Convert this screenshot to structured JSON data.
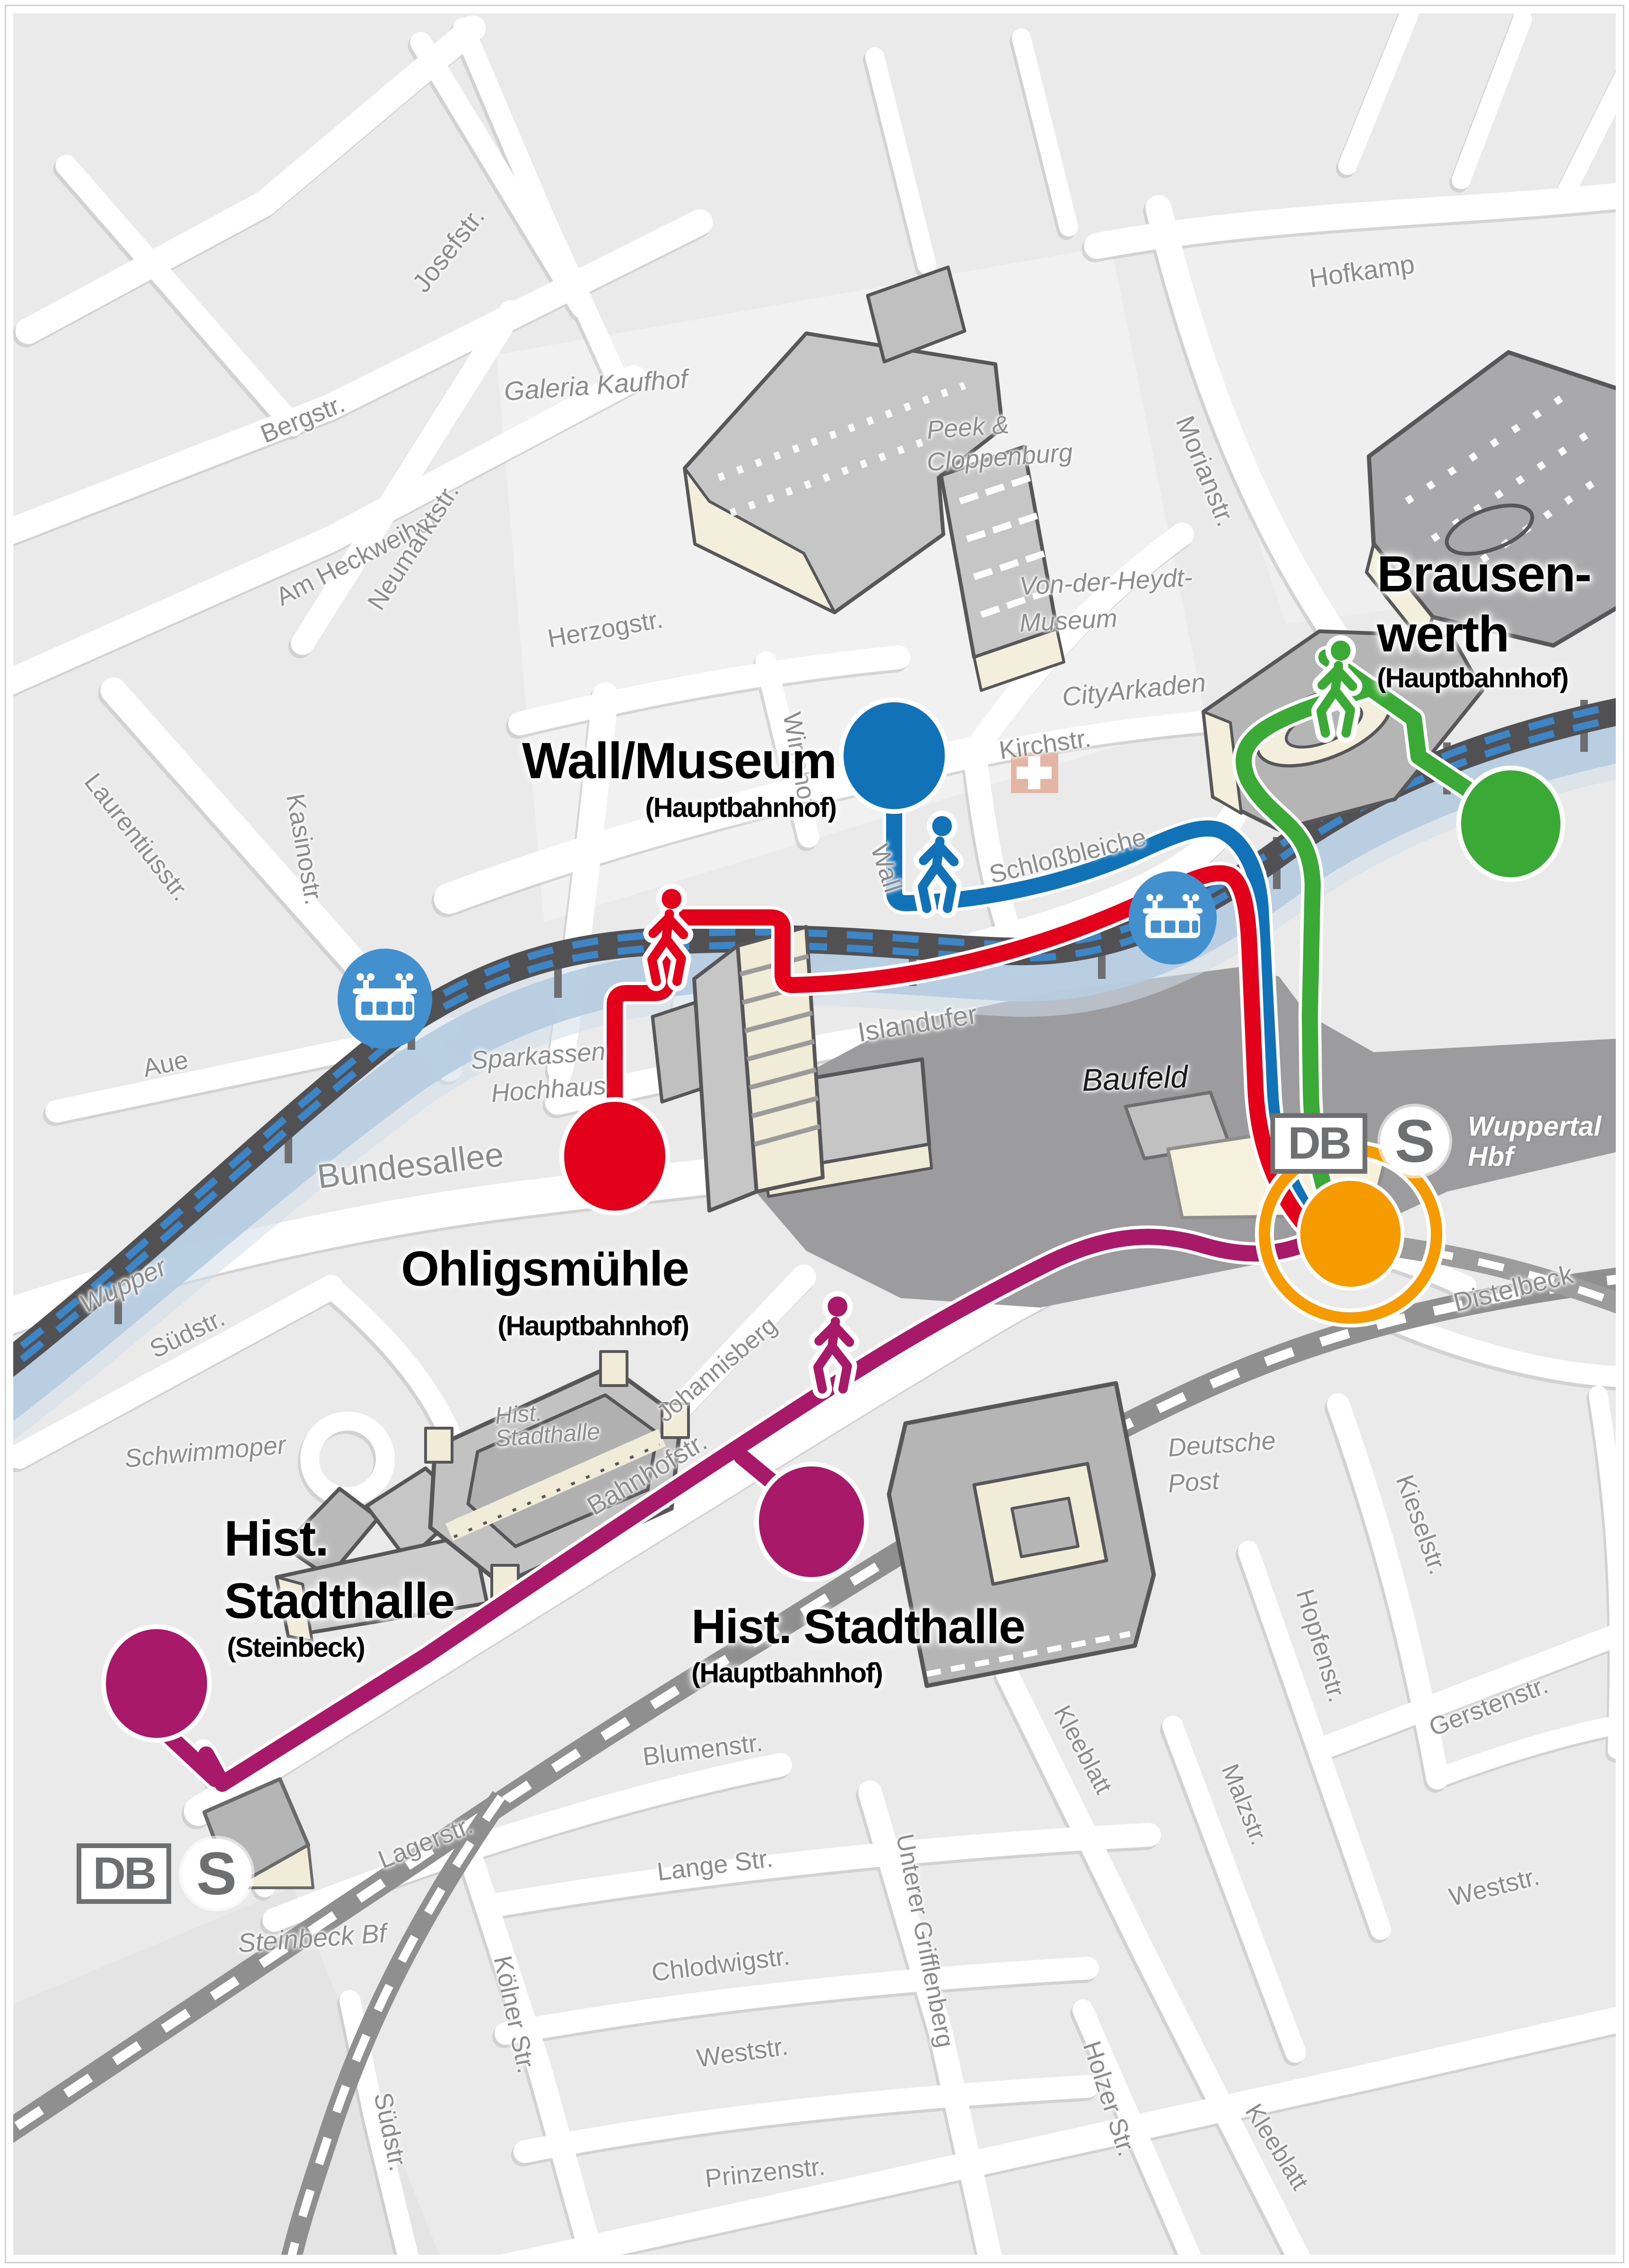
{
  "streets": {
    "josefstr": "Josefstr.",
    "bergstr": "Bergstr.",
    "am_heckweiher": "Am Heckweiher",
    "neumarktstr": "Neumarktstr.",
    "hofkamp": "Hofkamp",
    "morianstr": "Morianstr.",
    "herzogstr": "Herzogstr.",
    "wirmhof": "Wirmhof",
    "kirchstr": "Kirchstr.",
    "wall": "Wall",
    "schlossbleiche": "Schloßbleiche",
    "laurentiusstr": "Laurentiusstr.",
    "kasinostr": "Kasinostr.",
    "aue": "Aue",
    "islandufer": "Islandufer",
    "bundesallee": "Bundesallee",
    "suedstr_upper": "Südstr.",
    "johannisberg": "Johannisberg",
    "bahnhofstr": "Bahnhofstr.",
    "distelbeck": "Distelbeck",
    "kieselstr": "Kieselstr.",
    "hopfenstr": "Hopfenstr.",
    "gerstenstr": "Gerstenstr.",
    "kleeblatt_upper": "Kleeblatt",
    "kleeblatt_lower": "Kleeblatt",
    "malzstr": "Malzstr.",
    "weststr_right": "Weststr.",
    "weststr_center": "Weststr.",
    "holzer_str": "Holzer Str.",
    "blumenstr": "Blumenstr.",
    "lange_str": "Lange Str.",
    "chlodwigstr": "Chlodwigstr.",
    "koelner_str": "Kölner Str.",
    "unterer_grifflenberg": "Unterer Grifflenberg",
    "lagerstr": "Lagerstr.",
    "suedstr_lower": "Südstr.",
    "prinzenstr": "Prinzenstr."
  },
  "places": {
    "galeria_kaufhof": "Galeria Kaufhof",
    "peek_1": "Peek &",
    "peek_2": "Cloppenburg",
    "vdh_1": "Von-der-Heydt-",
    "vdh_2": "Museum",
    "cityarkaden": "CityArkaden",
    "sparkassen_1": "Sparkassen",
    "sparkassen_2": "Hochhaus",
    "baufeld": "Baufeld",
    "schwimmoper": "Schwimmoper",
    "hist_stadthalle_1": "Hist.",
    "hist_stadthalle_2": "Stadthalle",
    "deutsche_post_1": "Deutsche",
    "deutsche_post_2": "Post",
    "wupper": "Wupper"
  },
  "stops": {
    "wall_museum": {
      "name": "Wall/Museum",
      "sub": "(Hauptbahnhof)"
    },
    "brausenwerth": {
      "name_1": "Brausen-",
      "name_2": "werth",
      "sub": "(Hauptbahnhof)"
    },
    "ohligsmuehle": {
      "name": "Ohligsmühle",
      "sub": "(Hauptbahnhof)"
    },
    "hist_stadthalle_steinbeck": {
      "name_1": "Hist.",
      "name_2": "Stadthalle",
      "sub": "(Steinbeck)"
    },
    "hist_stadthalle_hbf": {
      "name": "Hist. Stadthalle",
      "sub": "(Hauptbahnhof)"
    }
  },
  "rail": {
    "db_logo": "DB",
    "sbahn_logo": "S",
    "wuppertal_hbf_1": "Wuppertal",
    "wuppertal_hbf_2": "Hbf",
    "steinbeck_bf": "Steinbeck Bf"
  },
  "icons": {
    "walker": "pedestrian-walking-figure",
    "schwebebahn_station": "suspension-railway-gondola-in-blue-circle",
    "church_cross": "white-cross-on-salmon-square",
    "stop_circle": "filled-ellipse-stop-marker",
    "hbf_ring": "orange-ring-highlight"
  },
  "colors": {
    "route_red": "#e3001b",
    "route_blue": "#1272b8",
    "route_green": "#3aa935",
    "route_purple": "#a81a69",
    "hbf_orange": "#f59b00",
    "schwebebahn_stop_blue": "#4390cf",
    "schwebebahn_track": "#515154",
    "schwebebahn_dash_blue": "#3c86c8",
    "railway_gray": "#8f8f8f",
    "river_blue": "#b6cde0",
    "baufeld_gray": "#9c9c9e",
    "street_label_gray": "#8c8c8c"
  }
}
